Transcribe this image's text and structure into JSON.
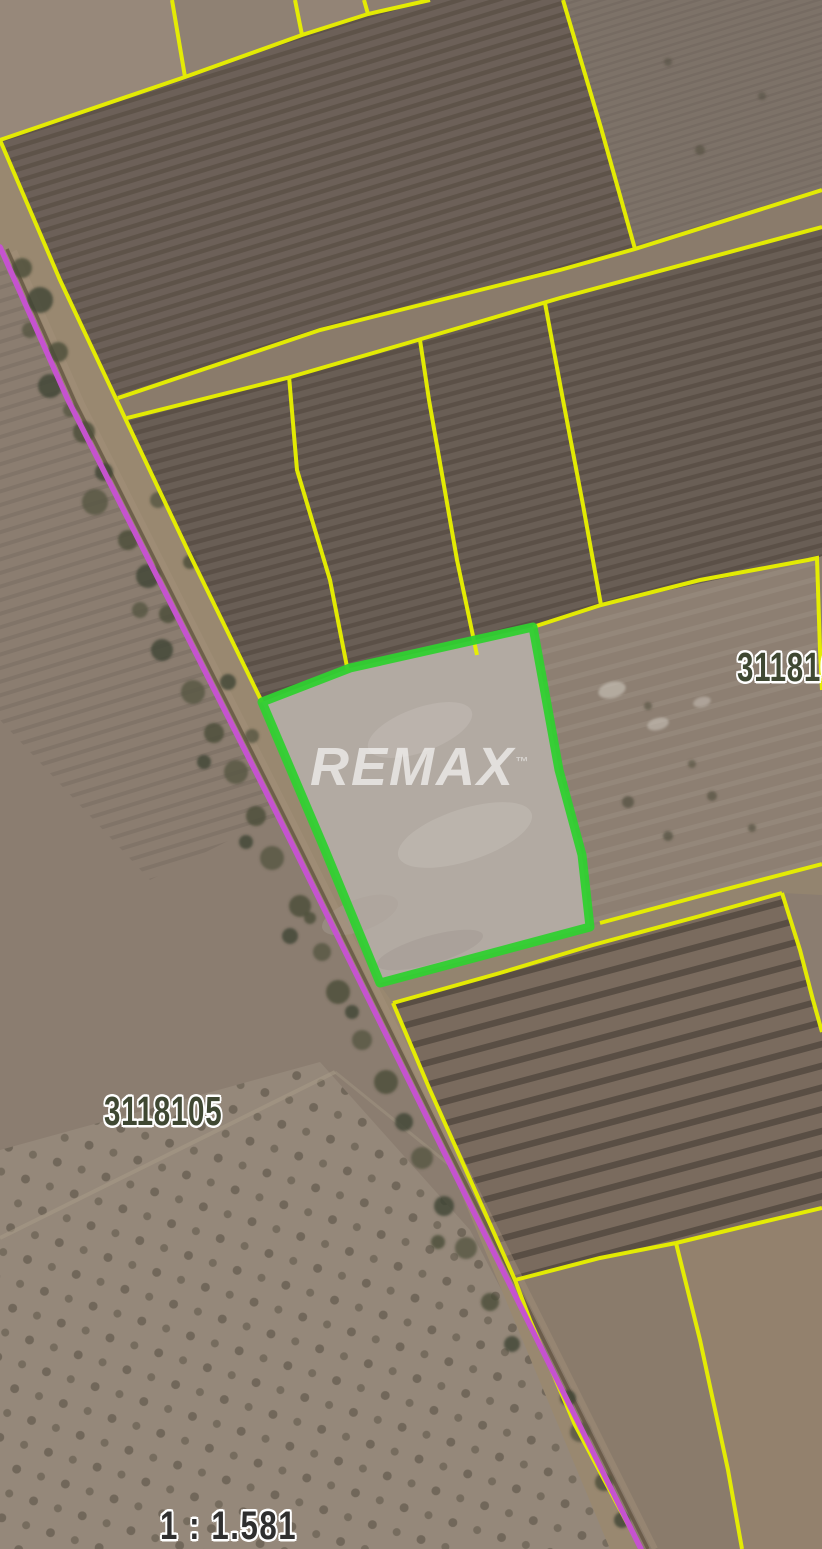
{
  "map": {
    "watermark": "REMAX",
    "watermark_tm": "™",
    "scale_text": "1 : 1.581",
    "parcel_label_left": "3118105",
    "parcel_label_right": "311810",
    "highlighted_parcel_name": "highlighted-listing-parcel"
  },
  "colors": {
    "boundary_yellow": "#e8f000",
    "road_purple": "#c553cf",
    "parcel_green": "#30d030",
    "parcel_fill": "#b2aaa2",
    "label_olive": "#3f4832",
    "scale_dark": "#2f2f2f",
    "halo_white": "#ffffff",
    "watermark_white": "rgba(255,255,255,0.62)"
  }
}
